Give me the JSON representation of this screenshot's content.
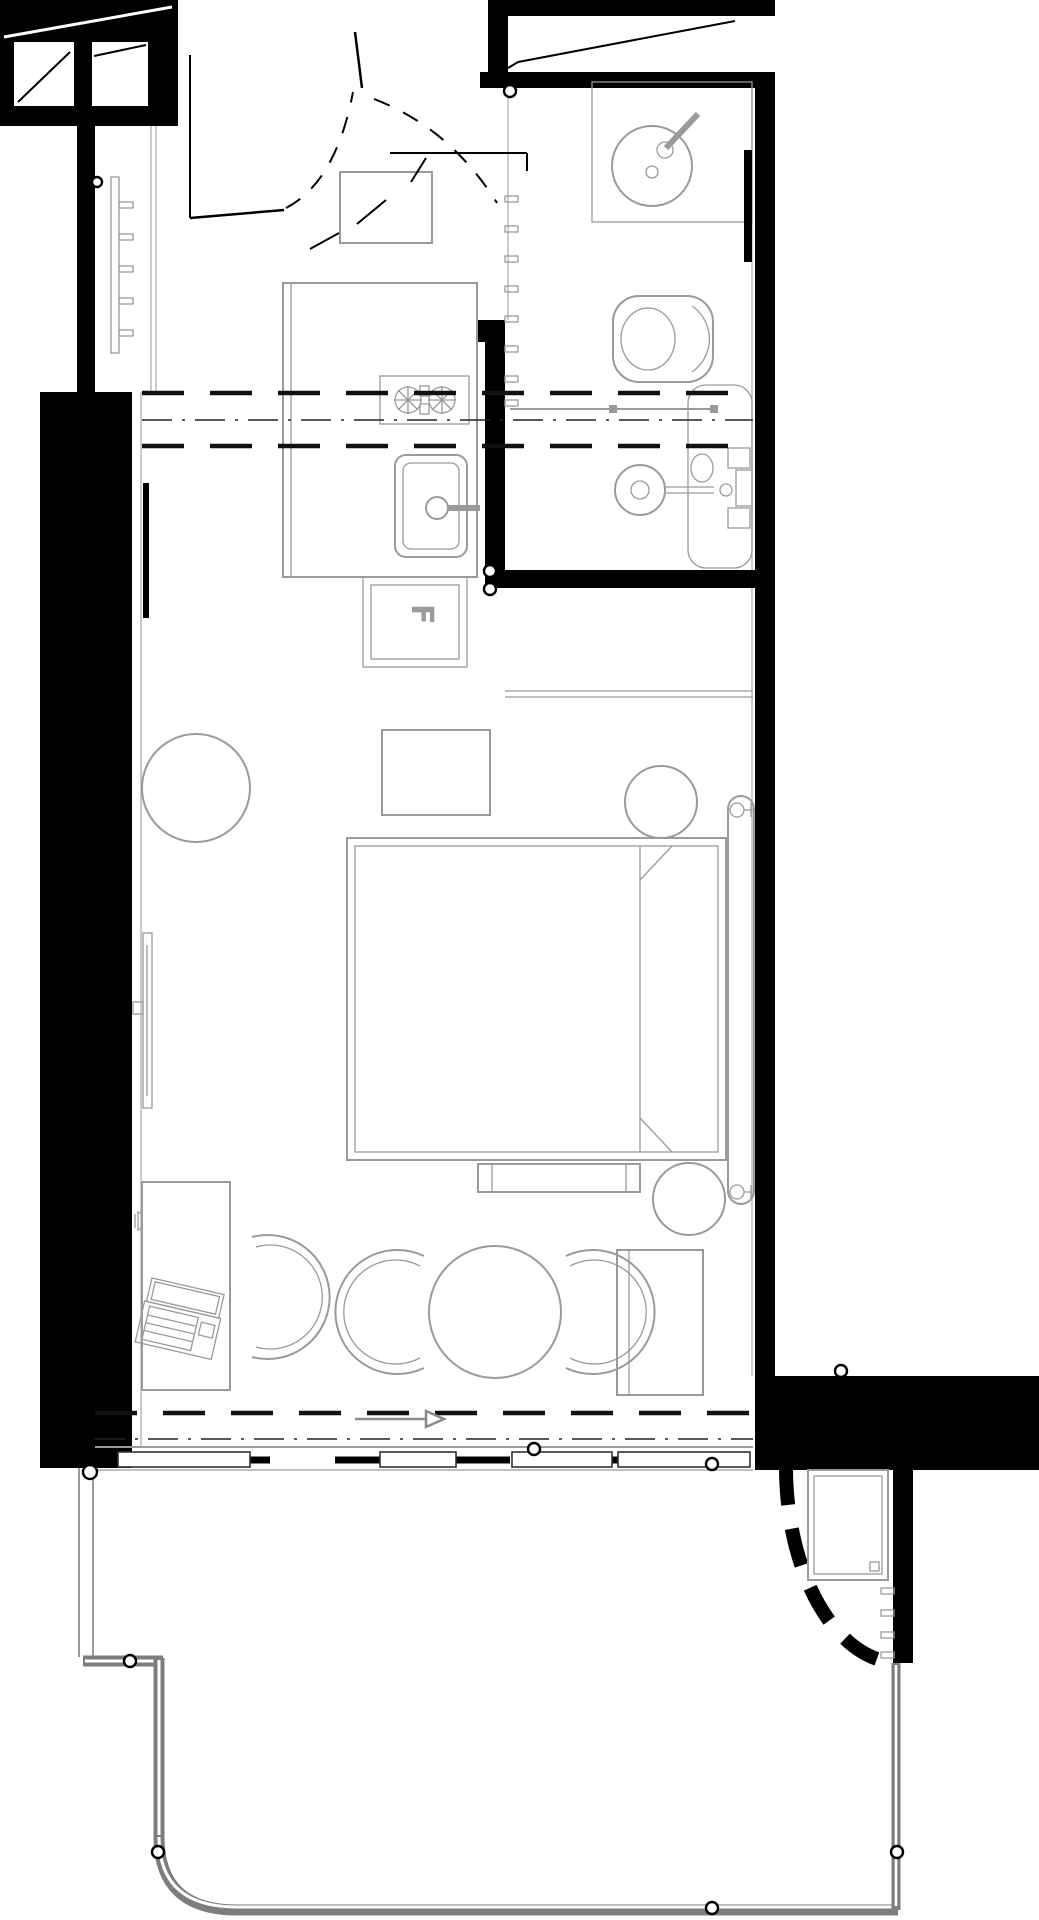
{
  "document": {
    "drawing_type": "architectural floor plan",
    "description": "black-and-white CAD plan of a studio room with entry, bathroom, kitchenette, bed and living area, sliding window wall and balcony with curved railing"
  },
  "labels": {
    "fridge": "F"
  },
  "colors": {
    "wall": "#000000",
    "fixture_line": "#9a9a9a",
    "railing": "#7d7d7d",
    "section_line": "#111111",
    "background": "#ffffff"
  },
  "fixtures": [
    "entry-door",
    "door-swing",
    "wardrobe",
    "radiator",
    "washbasin",
    "faucet",
    "mirror",
    "toilet",
    "shower-head",
    "shower-screen",
    "shower-controls",
    "towel-rail",
    "stove",
    "kitchen-sink",
    "under-counter-fridge",
    "bed",
    "headboard",
    "bedside-stool",
    "wall-sconce",
    "side-table",
    "pouf",
    "tv",
    "desk",
    "laptop",
    "desk-chair",
    "dining-table",
    "dining-chair",
    "bench",
    "console",
    "sliding-window",
    "balcony-railing",
    "ac-unit",
    "louvers"
  ]
}
